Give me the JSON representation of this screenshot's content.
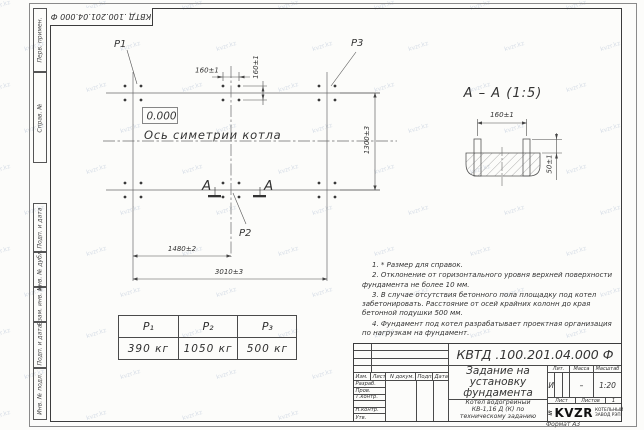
{
  "watermark_text": "kvzr.kz",
  "corner_stamp": "КВТД .100.201.04.000 Ф",
  "margin_labels": {
    "perv": "Перв. примен.",
    "sprav": "Справ. №",
    "podp1": "Подп. и дата",
    "inv_dubl": "Инв. № дубл.",
    "vzam": "Взам. инв. №",
    "podp2": "Подп. и дата",
    "inv_podl": "Инв. № подл."
  },
  "plan": {
    "p1": "P1",
    "p2": "P2",
    "p3": "P3",
    "elevation": "0.000",
    "axis_label": "Ось симетрии котла",
    "section_letter": "А",
    "dim_bolt_x": "160±1",
    "dim_bolt_y": "160±1",
    "dim_rows": "1300±3",
    "dim_left_mid": "1480±2",
    "dim_total": "3010±3"
  },
  "section": {
    "title": "А – А (1:5)",
    "dim_spacing": "160±1",
    "dim_protrusion": "50±1"
  },
  "loads_table": {
    "headers": [
      "P₁",
      "P₂",
      "P₃"
    ],
    "values": [
      "390 кг",
      "1050 кг",
      "500 кг"
    ]
  },
  "notes": [
    "1. * Размер для справок.",
    "2. Отклонение от горизонтального уровня верхней поверхности фундамента не более 10 мм.",
    "3. В случае отсутствия бетонного пола площадку под котел забетонировать. Расстояние от осей крайних колонн до края бетонной подушки 500 мм.",
    "4. Фундамент под котел разрабатывает проектная организация по нагрузкам на фундамент."
  ],
  "title_block": {
    "doc_number": "КВТД .100.201.04.000 Ф",
    "title": "Задание на установку фундамента",
    "subtitle": "Котел водогрейный КВ-1,16 Д (К) по техническому заданию",
    "col_izm": "Изм.",
    "col_list": "Лист",
    "col_doc": "N докум.",
    "col_sign": "Подп.",
    "col_date": "Дата",
    "row_razrab": "Разраб.",
    "row_prov": "Пров.",
    "row_tkontr": "Т.контр.",
    "row_nkontr": "Н.контр.",
    "row_utv": "Утв.",
    "lit_label": "Лит.",
    "mass_label": "Масса",
    "scale_label": "Масштаб",
    "lit_value": "И",
    "mass_value": "–",
    "scale_value": "1:20",
    "sheet_label": "Лист",
    "sheets_label": "Листов",
    "sheets_value": "1",
    "logo": "KVZR",
    "logo_caption": "КОТЕЛЬНЫЙ ЗАВОД РЭП",
    "format_label": "Формат А3"
  }
}
